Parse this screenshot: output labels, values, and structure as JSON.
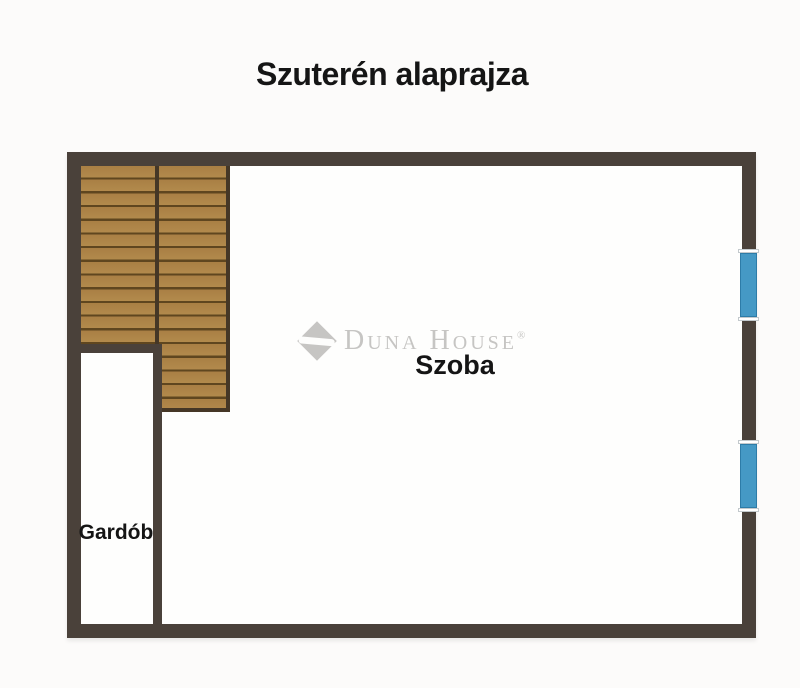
{
  "title": "Szuterén alaprajza",
  "rooms": {
    "szoba": {
      "label": "Szoba"
    },
    "gardob": {
      "label": "Gardób"
    }
  },
  "watermark": {
    "brand": "Duna House",
    "registered": "®"
  },
  "elements": {
    "staircase": "wooden-staircase-two-flights",
    "windows": [
      "window-upper-right",
      "window-lower-right"
    ]
  },
  "colors": {
    "background": "#fcfbfa",
    "text": "#151515",
    "wall": "#4a413a",
    "wood": "#a97f44",
    "wood_light": "#b28a4c",
    "wood_line": "#5f461f",
    "stair_frame": "#453726",
    "window_blue": "#4599c5",
    "window_frame": "#2d7ca8",
    "watermark": "#c6c5c3"
  }
}
